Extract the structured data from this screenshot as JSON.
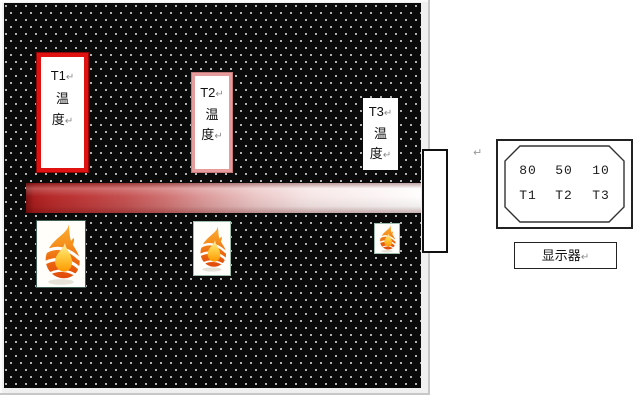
{
  "scene": {
    "title_hint": "heat-conduction-demo",
    "line_break_mark": "↵",
    "sensor_boxes": [
      {
        "name": "T1",
        "temp_char_1": "温",
        "temp_char_2": "度",
        "border_color": "#e01111"
      },
      {
        "name": "T2",
        "temp_char_1": "温",
        "temp_char_2": "度",
        "border_color": "#e49c9c"
      },
      {
        "name": "T3",
        "temp_char_1": "温",
        "temp_char_2": "度",
        "border_color": "#ffffff"
      }
    ],
    "readout": {
      "values": [
        "80",
        "50",
        "10"
      ],
      "channels": [
        "T1",
        "T2",
        "T3"
      ],
      "caption": "显示器"
    },
    "colors": {
      "board_background": "#0a0a0a",
      "board_dots": "#e8e8e8",
      "heat_bar_hot": "#7c1010",
      "heat_bar_cold": "#fffdfd",
      "t1_border": "#e01111",
      "t2_border": "#e49c9c",
      "flame_orange": "#f6921e",
      "flame_deep_orange": "#e1490a",
      "flame_yellow": "#ffd24a",
      "frame_gray": "#f0f0f0"
    },
    "icons": {
      "flame_large": "flame-icon",
      "flame_medium": "flame-icon",
      "flame_small": "flame-icon"
    }
  }
}
